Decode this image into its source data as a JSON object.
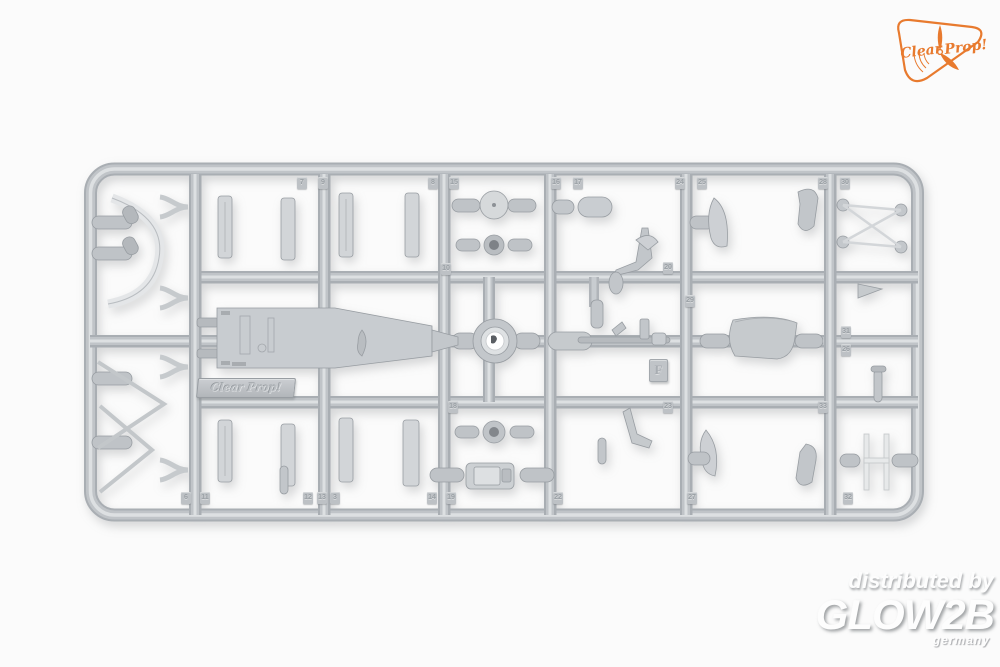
{
  "logo": {
    "word1": "Clear",
    "word2": "Prop!",
    "accent_color": "#e87a2e"
  },
  "watermark": {
    "line1": "distributed by",
    "line2": "GLOW2B",
    "line3": "germany"
  },
  "sprue": {
    "brand_plate_text": "Clear Prop!",
    "letter_tag": "F",
    "plastic_color": "#c2c6ca",
    "background_color": "#fbfbfb",
    "gate_tags": [
      {
        "label": "7",
        "x": 297,
        "y": 177
      },
      {
        "label": "9",
        "x": 318,
        "y": 177
      },
      {
        "label": "8",
        "x": 428,
        "y": 177
      },
      {
        "label": "15",
        "x": 449,
        "y": 177
      },
      {
        "label": "16",
        "x": 551,
        "y": 177
      },
      {
        "label": "17",
        "x": 573,
        "y": 177
      },
      {
        "label": "24",
        "x": 675,
        "y": 177
      },
      {
        "label": "25",
        "x": 697,
        "y": 177
      },
      {
        "label": "28",
        "x": 818,
        "y": 177
      },
      {
        "label": "30",
        "x": 840,
        "y": 177
      },
      {
        "label": "10",
        "x": 441,
        "y": 263
      },
      {
        "label": "20",
        "x": 663,
        "y": 262
      },
      {
        "label": "29",
        "x": 685,
        "y": 295
      },
      {
        "label": "31",
        "x": 841,
        "y": 326
      },
      {
        "label": "26",
        "x": 841,
        "y": 344
      },
      {
        "label": "18",
        "x": 448,
        "y": 401
      },
      {
        "label": "23",
        "x": 663,
        "y": 401
      },
      {
        "label": "33",
        "x": 818,
        "y": 401
      },
      {
        "label": "6",
        "x": 181,
        "y": 492
      },
      {
        "label": "11",
        "x": 200,
        "y": 492
      },
      {
        "label": "12",
        "x": 303,
        "y": 492
      },
      {
        "label": "13",
        "x": 317,
        "y": 492
      },
      {
        "label": "3",
        "x": 330,
        "y": 492
      },
      {
        "label": "14",
        "x": 427,
        "y": 492
      },
      {
        "label": "19",
        "x": 446,
        "y": 492
      },
      {
        "label": "22",
        "x": 553,
        "y": 492
      },
      {
        "label": "27",
        "x": 687,
        "y": 492
      },
      {
        "label": "32",
        "x": 843,
        "y": 492
      }
    ]
  }
}
